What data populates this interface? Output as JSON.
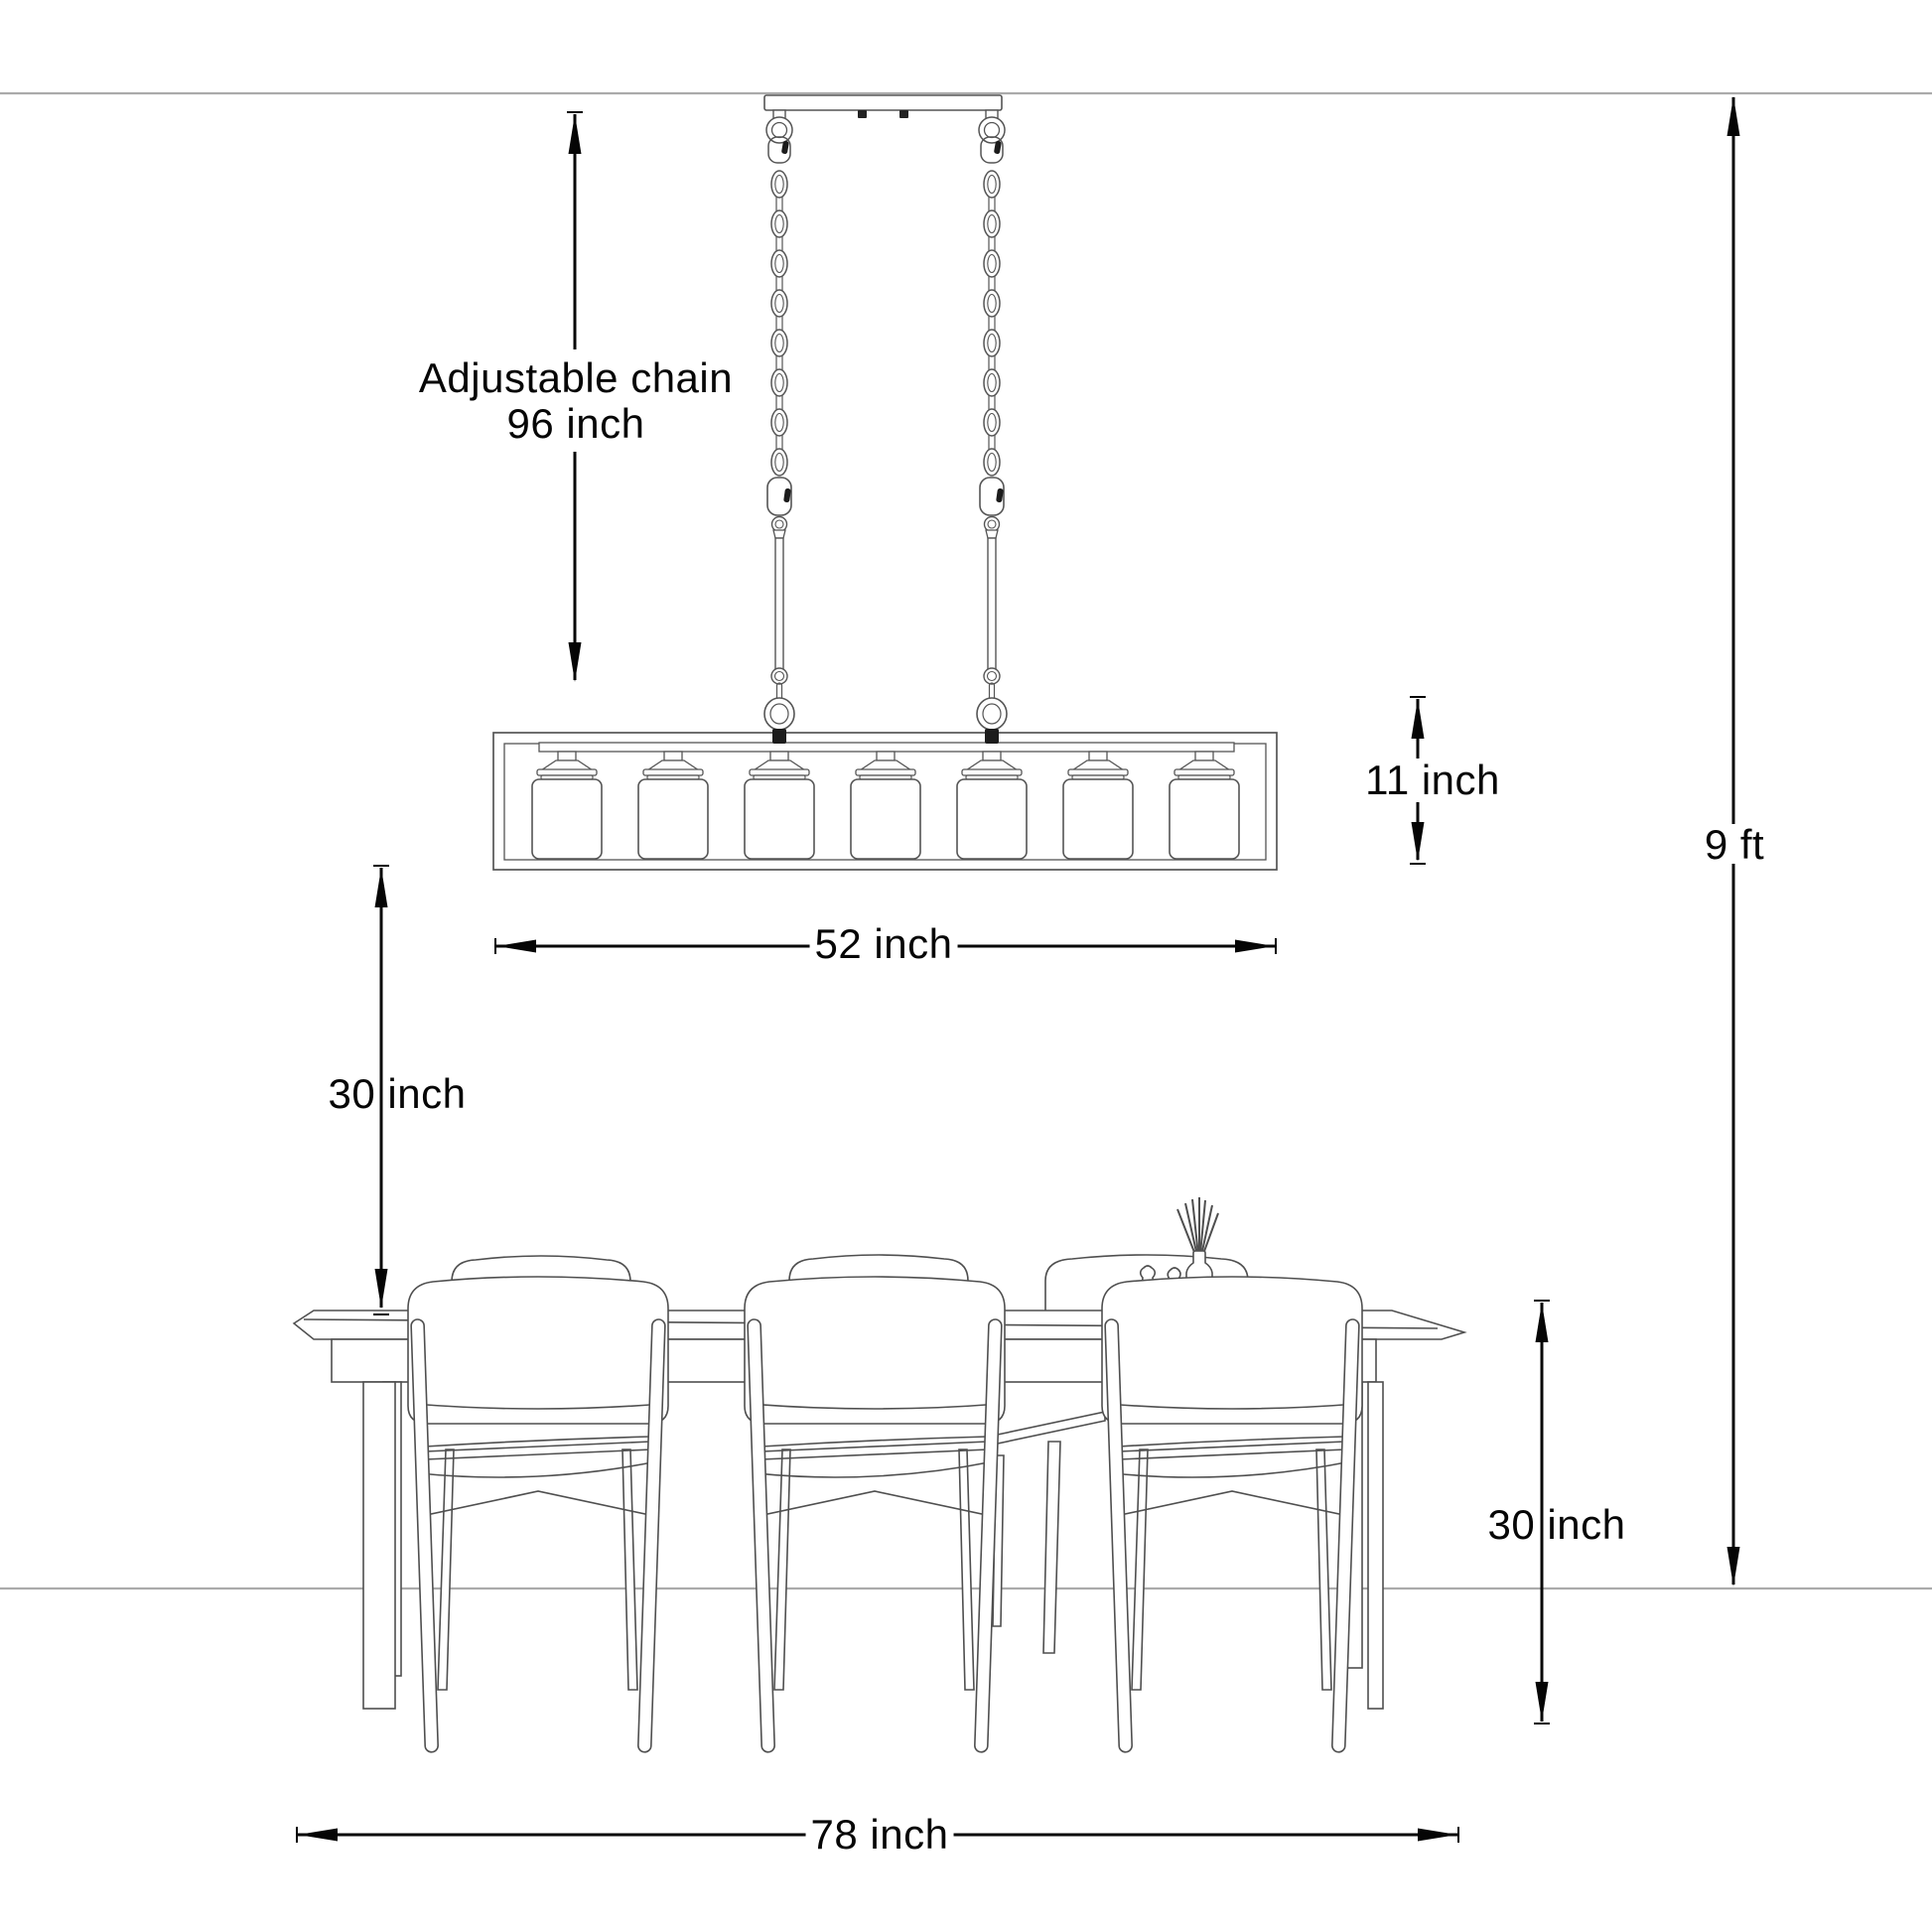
{
  "page": {
    "kind": "Product dimension diagram: 7-light linear chandelier hung above a dining table",
    "background": "#ffffff"
  },
  "annotations": {
    "chain": {
      "line1": "Adjustable chain",
      "line2": "96 inch"
    },
    "fixture_height": "11 inch",
    "fixture_width": "52 inch",
    "fixture_to_table": "30 inch",
    "ceiling_height": "9 ft",
    "table_height": "30 inch",
    "table_length": "78 inch"
  },
  "fixture": {
    "lights": 7,
    "chains": 2
  },
  "scene": {
    "front_chairs": 3,
    "far_chairs_visible": 2,
    "accessories": [
      "reed diffuser with sticks",
      "two small bottles"
    ]
  },
  "colors": {
    "dimension_ink": "#050505",
    "line_art": "#4f4f4f",
    "wall_line": "#ababab",
    "hardware_dark": "#1c1c1c"
  }
}
